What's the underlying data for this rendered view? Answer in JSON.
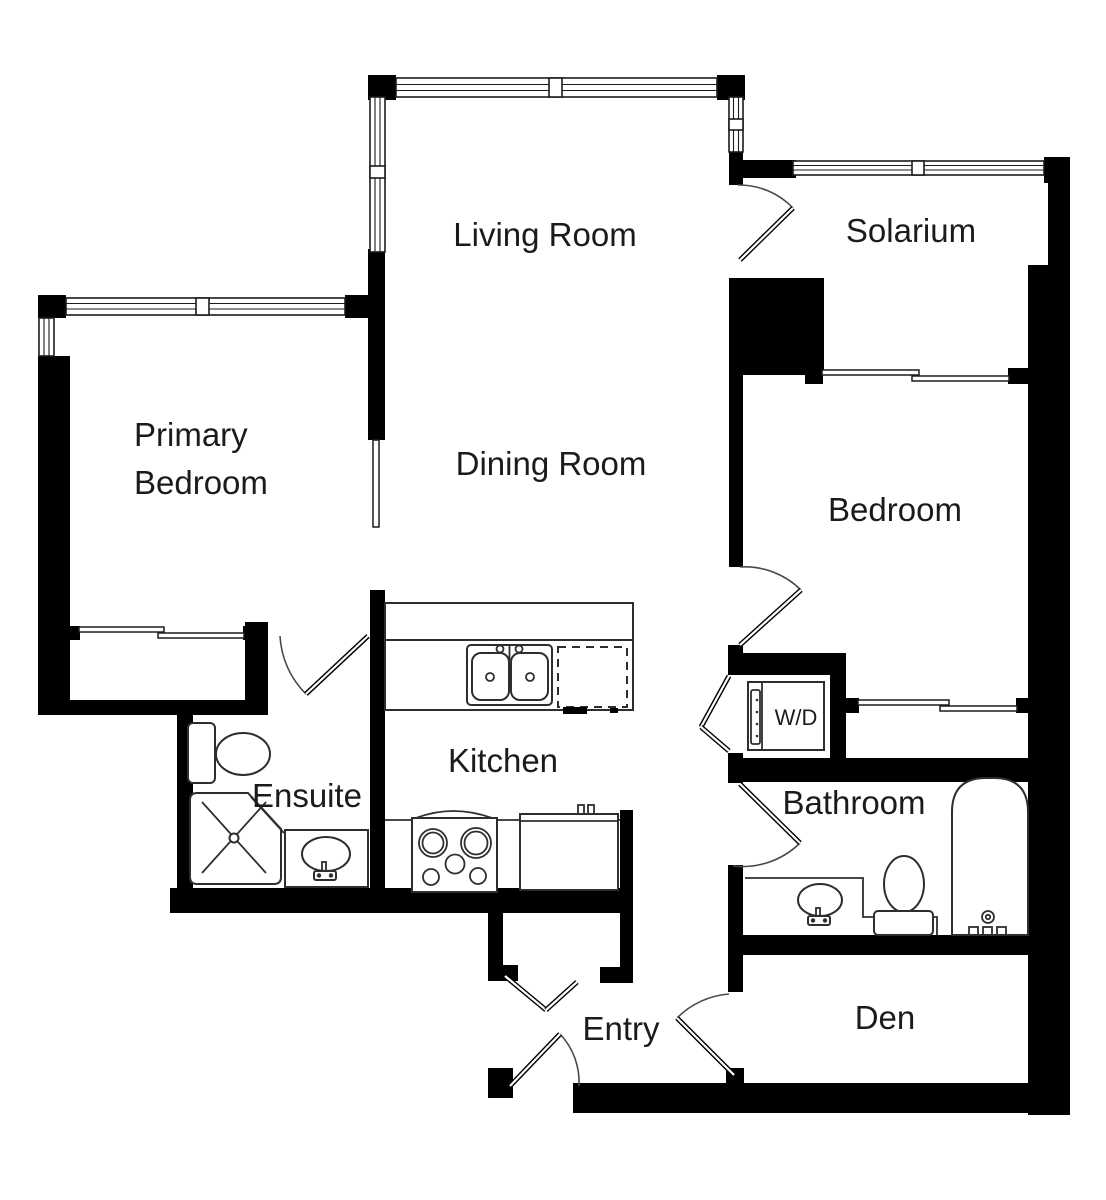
{
  "rooms": {
    "living_room": "Living Room",
    "solarium": "Solarium",
    "primary_bedroom_line1": "Primary",
    "primary_bedroom_line2": "Bedroom",
    "dining_room": "Dining Room",
    "bedroom": "Bedroom",
    "kitchen": "Kitchen",
    "ensuite": "Ensuite",
    "bathroom": "Bathroom",
    "laundry_closet": "W/D",
    "entry": "Entry",
    "den": "Den"
  },
  "colors": {
    "wall": "#000000",
    "line": "#2e2e2e",
    "background": "#ffffff",
    "text": "#1b1b1b"
  }
}
